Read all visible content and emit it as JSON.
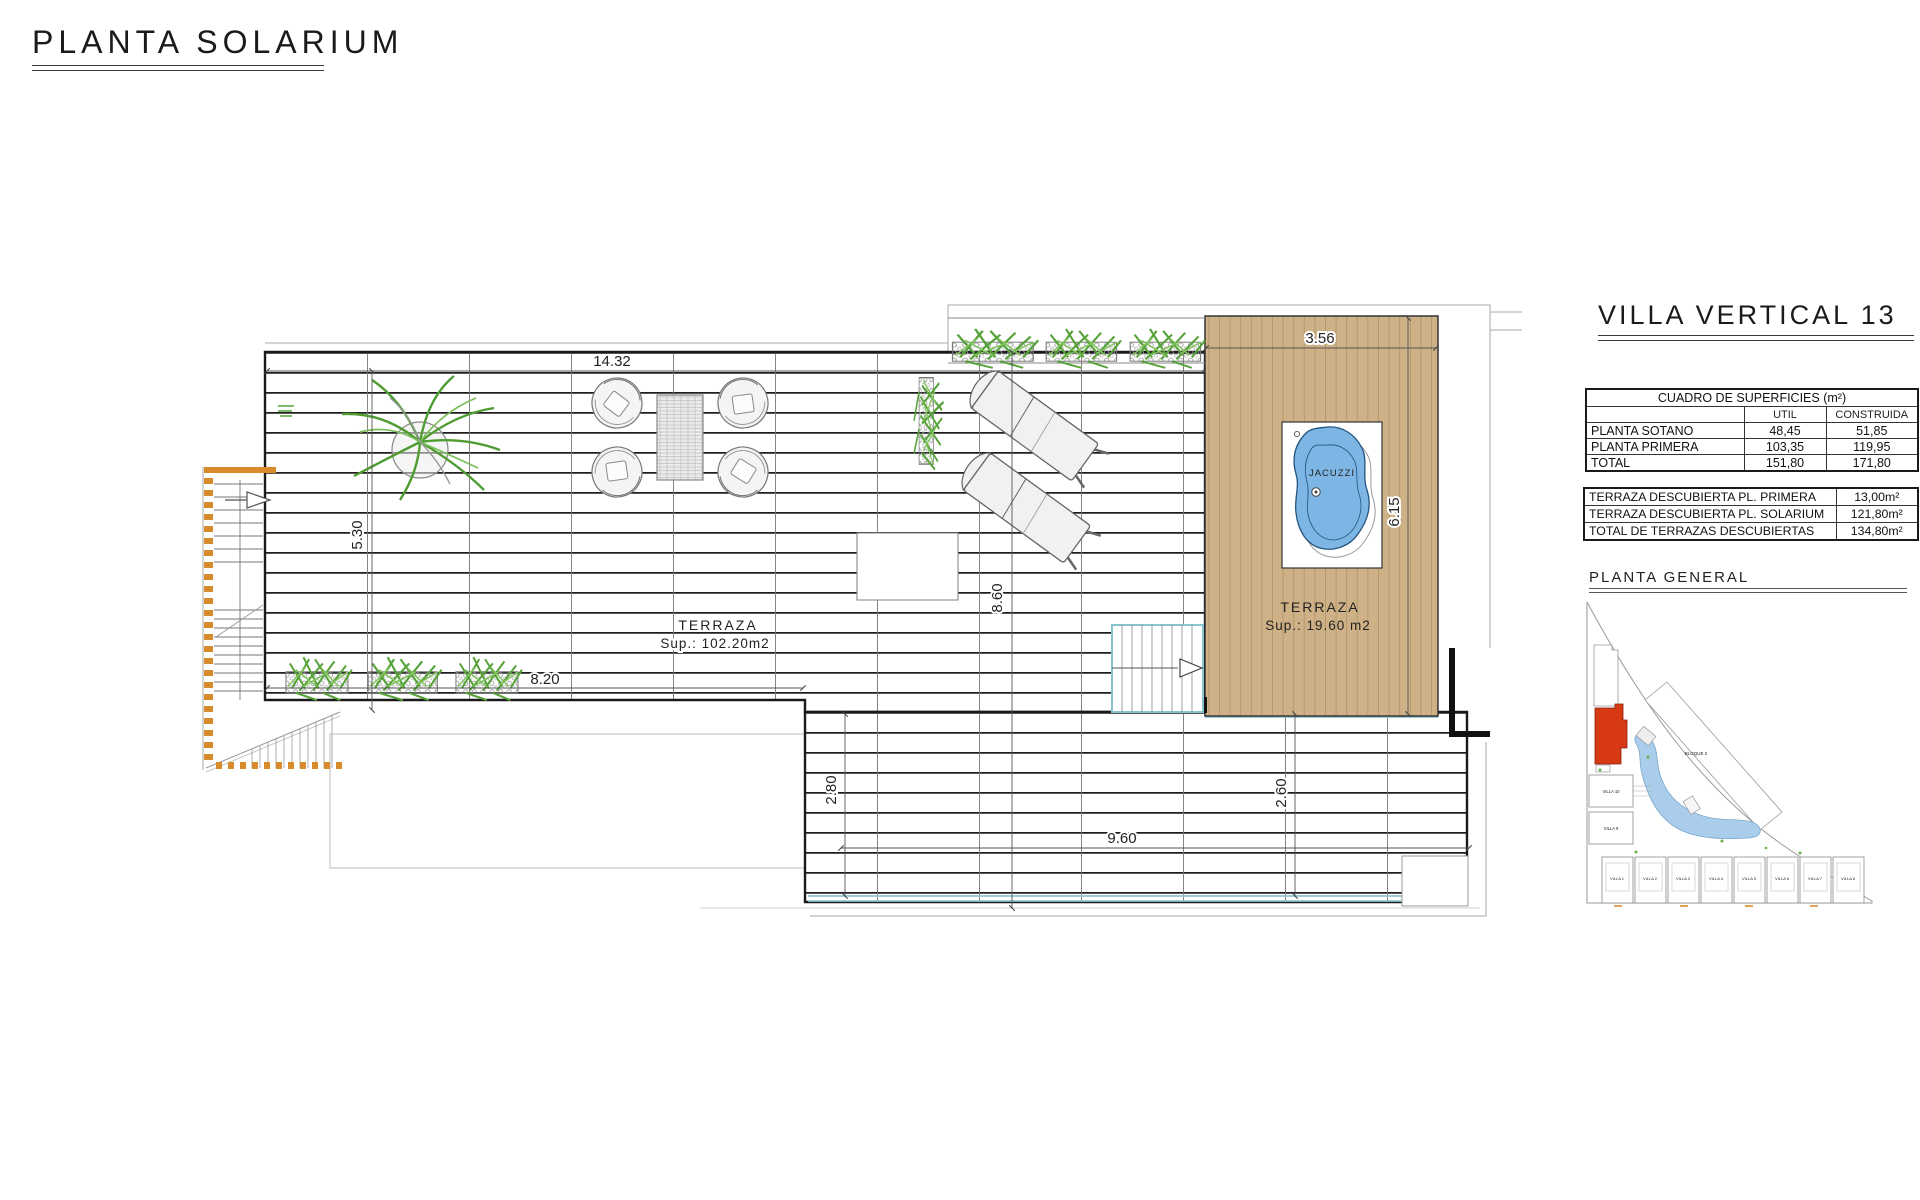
{
  "page": {
    "title": "PLANTA SOLARIUM"
  },
  "panel": {
    "title": "VILLA VERTICAL 13",
    "surfaces_table": {
      "title": "CUADRO DE SUPERFICIES (m²)",
      "col_util": "UTIL",
      "col_construida": "CONSTRUIDA",
      "rows": [
        {
          "label": "PLANTA SOTANO",
          "util": "48,45",
          "construida": "51,85"
        },
        {
          "label": "PLANTA PRIMERA",
          "util": "103,35",
          "construida": "119,95"
        },
        {
          "label": "TOTAL",
          "util": "151,80",
          "construida": "171,80"
        }
      ]
    },
    "terraces_table": {
      "rows": [
        {
          "label": "TERRAZA DESCUBIERTA PL. PRIMERA",
          "value": "13,00m²"
        },
        {
          "label": "TERRAZA DESCUBIERTA PL. SOLARIUM",
          "value": "121,80m²"
        },
        {
          "label": "TOTAL DE TERRAZAS DESCUBIERTAS",
          "value": "134,80m²"
        }
      ]
    },
    "site_plan": {
      "title": "PLANTA  GENERAL",
      "labels": [
        "VILLA 1",
        "VILLA 2",
        "VILLA 3",
        "VILLA 4",
        "VILLA 5",
        "VILLA 6",
        "VILLA 7",
        "VILLA 8",
        "VILLA 9",
        "VILLA 10",
        "BLOQUE 2"
      ],
      "highlight_color": "#d63913"
    }
  },
  "plan": {
    "rooms": {
      "terrace_main": {
        "name": "TERRAZA",
        "area": "Sup.: 102.20m2"
      },
      "terrace_solarium": {
        "name": "TERRAZA",
        "area": "Sup.: 19.60  m2"
      },
      "jacuzzi_label": "JACUZZI"
    },
    "dimensions": {
      "top_width": "14.32",
      "solarium_width": "3.56",
      "left_height": "5.30",
      "mid_height": "8.60",
      "solarium_height": "6.15",
      "planter_width": "8.20",
      "lower_left_height": "2.80",
      "lower_right_height": "2.60",
      "lower_width": "9.60"
    },
    "colors": {
      "wood": "#cfb187",
      "water": "#7db6e4",
      "plant": "#55a338",
      "accent_orange": "#d78b2a",
      "edge_teal": "#8fc6cc"
    }
  }
}
